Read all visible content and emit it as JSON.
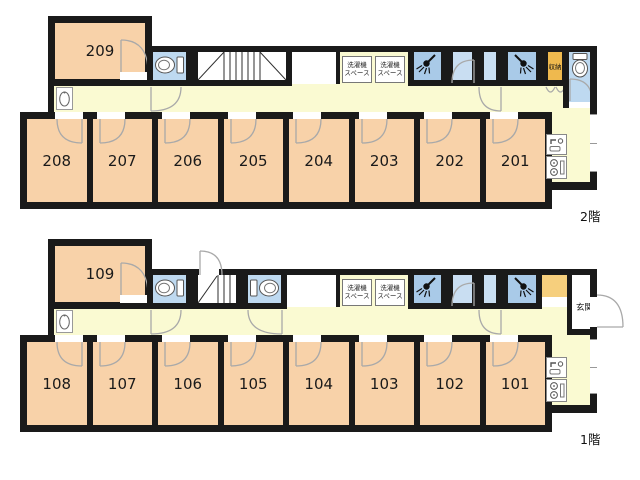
{
  "palette": {
    "wall": "#1a1a1a",
    "room_fill": "#f8d2a9",
    "corridor_fill": "#fafad2",
    "toilet_fill": "#bed9f0",
    "shower_fill": "#a9cae8",
    "dressing_fill": "#c9def2",
    "storage_fill": "#efb94e",
    "entrance_cabinet_fill": "#f6cf7d"
  },
  "icons": {
    "toilet": "toilet-icon",
    "shower": "shower-icon",
    "washbasin": "washbasin-icon",
    "sink": "kitchen-sink-icon",
    "stove": "stove-icon",
    "stairs": "stairs-symbol"
  },
  "floors": [
    {
      "label": "2階",
      "big_room": "209",
      "rooms": [
        "208",
        "207",
        "206",
        "205",
        "204",
        "203",
        "202",
        "201"
      ],
      "laundry_line1": "洗濯機",
      "laundry_line2": "スペース",
      "storage": "収納"
    },
    {
      "label": "1階",
      "big_room": "109",
      "rooms": [
        "108",
        "107",
        "106",
        "105",
        "104",
        "103",
        "102",
        "101"
      ],
      "laundry_line1": "洗濯機",
      "laundry_line2": "スペース",
      "entrance": "玄関"
    }
  ]
}
